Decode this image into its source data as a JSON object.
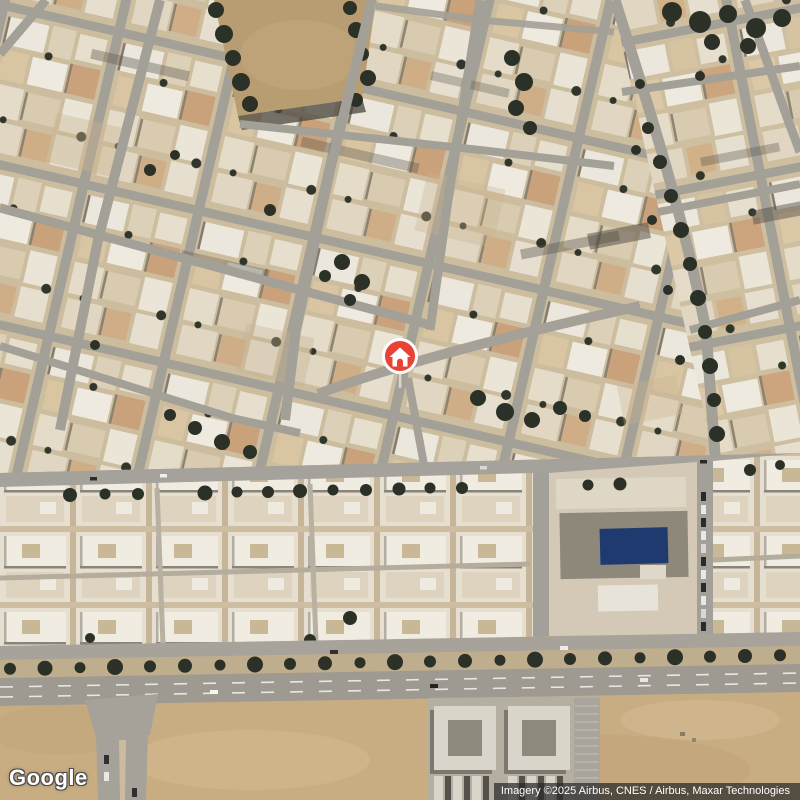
{
  "map": {
    "view_type": "satellite",
    "marker": {
      "icon": "home-icon",
      "shape": "red-circle-pin-with-stem"
    }
  },
  "branding": {
    "logo_text": "Google"
  },
  "attribution": {
    "text": "Imagery ©2025 Airbus, CNES / Airbus, Maxar Technologies"
  },
  "colors": {
    "marker_red": "#EA4335",
    "marker_ring_white": "#ffffff",
    "pool_blue": "#1f3a6e",
    "sand": "#c9ad82",
    "dirt_lot": "#b89d73",
    "road_gray": "#a3a097",
    "tree_green": "#2c3127",
    "attribution_text": "#ffffff"
  }
}
